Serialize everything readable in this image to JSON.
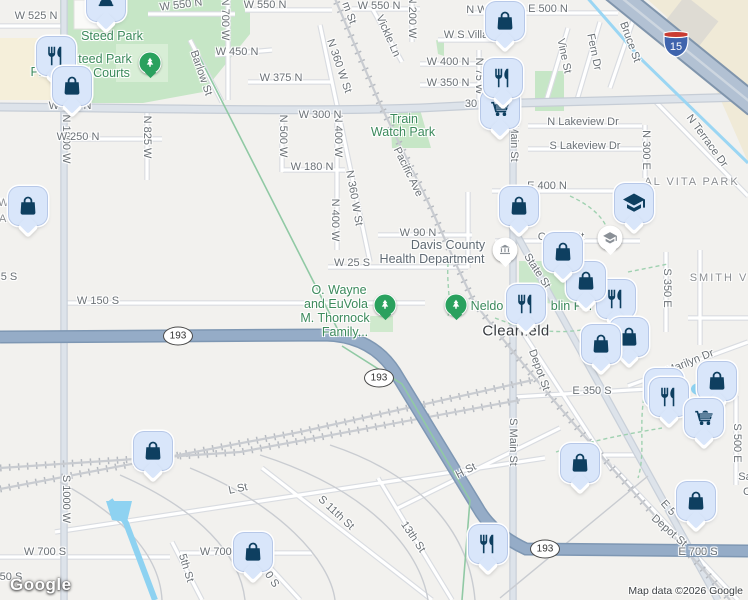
{
  "map": {
    "watermark": "Google",
    "attribution": "Map data ©2026 Google",
    "colors": {
      "pin_fill": "#d9e6fa",
      "pin_icon": "#0e3f60",
      "park_green": "#c6e6c6",
      "highway_blue": "#95acc7",
      "water_blue": "#8ed2f1",
      "park_label_green": "#3c8a5c"
    },
    "city_label": {
      "text": "Clearfield",
      "x": 516,
      "y": 331
    },
    "street_labels": [
      {
        "text": "W 525 N",
        "x": 36,
        "y": 16
      },
      {
        "text": "W 550 N",
        "x": 181,
        "y": 5,
        "rot": -7
      },
      {
        "text": "W 550 N",
        "x": 265,
        "y": 5
      },
      {
        "text": "W 550 N",
        "x": 379,
        "y": 6
      },
      {
        "text": "N 700 W",
        "x": 225,
        "y": 19,
        "rot": 90
      },
      {
        "text": "N 200 W",
        "x": 412,
        "y": 17,
        "rot": 90
      },
      {
        "text": "m St",
        "x": 349,
        "y": 13,
        "rot": 70
      },
      {
        "text": "Vickle Ln",
        "x": 388,
        "y": 36,
        "rot": 66
      },
      {
        "text": "W 450 N",
        "x": 237,
        "y": 52
      },
      {
        "text": "Barlow St",
        "x": 201,
        "y": 73,
        "rot": 71
      },
      {
        "text": "N 360 W St",
        "x": 339,
        "y": 66,
        "rot": 71
      },
      {
        "text": "W 375 N",
        "x": 281,
        "y": 78
      },
      {
        "text": "W S Villa",
        "x": 466,
        "y": 35
      },
      {
        "text": "N W",
        "x": 477,
        "y": 10
      },
      {
        "text": "W 400 N",
        "x": 448,
        "y": 62
      },
      {
        "text": "W 350 N",
        "x": 448,
        "y": 83
      },
      {
        "text": "N 75 W",
        "x": 479,
        "y": 76,
        "rot": 90
      },
      {
        "text": "E 500 N",
        "x": 548,
        "y": 9
      },
      {
        "text": "Vine St",
        "x": 564,
        "y": 56,
        "rot": 78
      },
      {
        "text": "Fern Dr",
        "x": 594,
        "y": 52,
        "rot": 78
      },
      {
        "text": "Bruce St",
        "x": 630,
        "y": 42,
        "rot": 70
      },
      {
        "text": "N Terrace Dr",
        "x": 707,
        "y": 141,
        "rot": 54
      },
      {
        "text": "N 300 E",
        "x": 646,
        "y": 150,
        "rot": 90
      },
      {
        "text": "N Lakeview Dr",
        "x": 583,
        "y": 122
      },
      {
        "text": "S Lakeview Dr",
        "x": 585,
        "y": 146
      },
      {
        "text": "E 400 N",
        "x": 547,
        "y": 186
      },
      {
        "text": "N 1000 W",
        "x": 66,
        "y": 139,
        "rot": 90
      },
      {
        "text": "N 825 W",
        "x": 147,
        "y": 137,
        "rot": 90
      },
      {
        "text": "W 250 N",
        "x": 78,
        "y": 137
      },
      {
        "text": "N 500 W",
        "x": 283,
        "y": 136,
        "rot": 90
      },
      {
        "text": "N 400 W",
        "x": 338,
        "y": 136,
        "rot": 90
      },
      {
        "text": "W 180 N",
        "x": 312,
        "y": 167
      },
      {
        "text": "N 360 W St",
        "x": 354,
        "y": 198,
        "rot": 80
      },
      {
        "text": "N 400 W",
        "x": 335,
        "y": 220,
        "rot": 90
      },
      {
        "text": "Pacific Ave",
        "x": 408,
        "y": 172,
        "rot": 64
      },
      {
        "text": "W 300 N",
        "x": 70,
        "y": 106
      },
      {
        "text": "W 300 N",
        "x": 320,
        "y": 115
      },
      {
        "text": "30",
        "x": 471,
        "y": 104
      },
      {
        "text": "Main St",
        "x": 514,
        "y": 143,
        "rot": 90
      },
      {
        "text": "W 90 N",
        "x": 418,
        "y": 233
      },
      {
        "text": "W 25 S",
        "x": 352,
        "y": 263
      },
      {
        "text": "Center St",
        "x": 561,
        "y": 237
      },
      {
        "text": "State St",
        "x": 537,
        "y": 271,
        "rot": 57
      },
      {
        "text": "W 150 S",
        "x": 98,
        "y": 301
      },
      {
        "text": "5 S",
        "x": 9,
        "y": 277
      },
      {
        "text": "S 350 E",
        "x": 667,
        "y": 288,
        "rot": 90
      },
      {
        "text": "E 350 S",
        "x": 592,
        "y": 391
      },
      {
        "text": "Marilyn Dr",
        "x": 690,
        "y": 362,
        "rot": -22
      },
      {
        "text": "Depot St",
        "x": 539,
        "y": 370,
        "rot": 70
      },
      {
        "text": "S Main St",
        "x": 513,
        "y": 442,
        "rot": 90
      },
      {
        "text": "H St",
        "x": 466,
        "y": 471,
        "rot": -27
      },
      {
        "text": "S 500 E",
        "x": 737,
        "y": 443,
        "rot": 90
      },
      {
        "text": "S 1000 W",
        "x": 66,
        "y": 499,
        "rot": 90
      },
      {
        "text": "L St",
        "x": 238,
        "y": 489,
        "rot": -12
      },
      {
        "text": "S 11th St",
        "x": 336,
        "y": 513,
        "rot": 43
      },
      {
        "text": "13th St",
        "x": 413,
        "y": 537,
        "rot": 56
      },
      {
        "text": "5th St",
        "x": 186,
        "y": 568,
        "rot": 73
      },
      {
        "text": "W 700 S",
        "x": 45,
        "y": 552
      },
      {
        "text": "W 700 S",
        "x": 221,
        "y": 552
      },
      {
        "text": "00 S",
        "x": 270,
        "y": 577,
        "rot": 56
      },
      {
        "text": "50 S",
        "x": 11,
        "y": 577
      },
      {
        "text": "E 5",
        "x": 668,
        "y": 508,
        "rot": 48
      },
      {
        "text": "Depot St",
        "x": 669,
        "y": 531,
        "rot": 41
      },
      {
        "text": "E 700 S",
        "x": 698,
        "y": 552
      },
      {
        "text": "Sa",
        "x": 745,
        "y": 477
      },
      {
        "text": "C",
        "x": 747,
        "y": 492
      }
    ],
    "area_labels": [
      {
        "text": "WOOD",
        "x": 20,
        "y": 203
      },
      {
        "text": "ATES",
        "x": 17,
        "y": 219
      },
      {
        "text": "AL VITA PARK",
        "x": 692,
        "y": 182
      },
      {
        "text": "SMITH V",
        "x": 719,
        "y": 278
      }
    ],
    "park_labels": [
      {
        "text": "Steed Park",
        "x": 112,
        "y": 36
      },
      {
        "text": "teed Park",
        "x": 105,
        "y": 59
      },
      {
        "text": "ll Courts",
        "x": 107,
        "y": 73
      },
      {
        "text": "Pl",
        "x": 36,
        "y": 72
      },
      {
        "text": "Train",
        "x": 404,
        "y": 119
      },
      {
        "text": "Watch Park",
        "x": 403,
        "y": 132
      },
      {
        "text": "O. Wayne",
        "x": 339,
        "y": 290
      },
      {
        "text": "and EuVola",
        "x": 336,
        "y": 304
      },
      {
        "text": "M. Thornock",
        "x": 335,
        "y": 318
      },
      {
        "text": "Family...",
        "x": 345,
        "y": 332
      },
      {
        "text": "Neldo",
        "x": 487,
        "y": 306
      },
      {
        "text": "blin Par",
        "x": 572,
        "y": 306
      }
    ],
    "poi_labels": [
      {
        "text": "Davis County",
        "x": 448,
        "y": 245
      },
      {
        "text": "Health Department",
        "x": 432,
        "y": 259
      }
    ],
    "shields": [
      {
        "type": "oval",
        "text": "193",
        "x": 178,
        "y": 336
      },
      {
        "type": "oval",
        "text": "193",
        "x": 379,
        "y": 378
      },
      {
        "type": "oval",
        "text": "193",
        "x": 545,
        "y": 549
      },
      {
        "type": "interstate",
        "text": "15",
        "x": 676,
        "y": 44
      }
    ],
    "pins": [
      {
        "icon": "picnic-dome",
        "x": 106,
        "y": 2
      },
      {
        "icon": "restaurant",
        "x": 56,
        "y": 56
      },
      {
        "icon": "shopping-bag",
        "x": 72,
        "y": 86
      },
      {
        "icon": "shopping-bag",
        "x": 28,
        "y": 206
      },
      {
        "icon": "shopping-cart",
        "x": 500,
        "y": 109
      },
      {
        "icon": "restaurant",
        "x": 503,
        "y": 78
      },
      {
        "icon": "shopping-bag",
        "x": 505,
        "y": 21
      },
      {
        "icon": "shopping-bag",
        "x": 519,
        "y": 206
      },
      {
        "icon": "school",
        "x": 634,
        "y": 203
      },
      {
        "icon": "restaurant",
        "x": 616,
        "y": 299
      },
      {
        "icon": "shopping-bag",
        "x": 586,
        "y": 281
      },
      {
        "icon": "shopping-bag",
        "x": 563,
        "y": 252
      },
      {
        "icon": "restaurant",
        "x": 526,
        "y": 304
      },
      {
        "icon": "shopping-bag",
        "x": 629,
        "y": 337
      },
      {
        "icon": "shopping-bag",
        "x": 601,
        "y": 344
      },
      {
        "icon": "shopping-bag",
        "x": 153,
        "y": 451
      },
      {
        "icon": "shopping-bag",
        "x": 580,
        "y": 463
      },
      {
        "icon": "restaurant",
        "x": 664,
        "y": 388
      },
      {
        "icon": "restaurant",
        "x": 669,
        "y": 397
      },
      {
        "icon": "shopping-bag",
        "x": 717,
        "y": 381
      },
      {
        "icon": "shopping-cart",
        "x": 704,
        "y": 418
      },
      {
        "icon": "shopping-bag",
        "x": 696,
        "y": 501
      },
      {
        "icon": "restaurant",
        "x": 488,
        "y": 544
      },
      {
        "icon": "shopping-bag",
        "x": 253,
        "y": 552
      }
    ],
    "small_pois": [
      {
        "icon": "museum",
        "x": 505,
        "y": 250
      },
      {
        "icon": "school",
        "x": 610,
        "y": 238
      }
    ],
    "tree_markers": [
      {
        "x": 150,
        "y": 63
      },
      {
        "x": 385,
        "y": 305
      },
      {
        "x": 456,
        "y": 305
      }
    ]
  }
}
